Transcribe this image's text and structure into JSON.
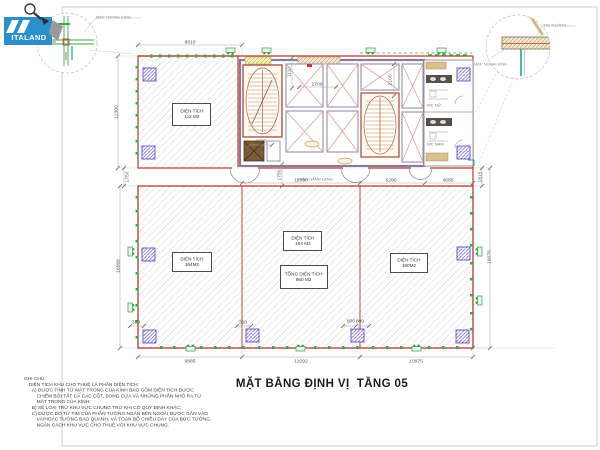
{
  "brand": {
    "name": "ITALAND"
  },
  "title": "MẶT BẰNG ĐỊNH VỊ  TẦNG 05",
  "detail_callouts": {
    "inner_glass_edge": "MÉP TRONG KÍNH",
    "wall_axis": "TIM TƯỜNG",
    "outer_glass_edge": "MÉP NGOÀI KÍNH"
  },
  "areas": {
    "room_nw": {
      "line1": "DIỆN TÍCH",
      "line2": "112 M2"
    },
    "room_sw": {
      "line1": "DIỆN TÍCH",
      "line2": "164M2"
    },
    "room_sc": {
      "line1": "DIỆN TÍCH",
      "line2": "194 M2"
    },
    "room_total": {
      "line1": "TỔNG DIỆN TÍCH",
      "line2": "660 M2"
    },
    "room_se": {
      "line1": "DIỆN TÍCH",
      "line2": "190M2"
    }
  },
  "zones": {
    "corridor": "PHẦN HÀNH LANG",
    "wc_female": "WC NỮ",
    "wc_male": "WC NAM"
  },
  "dims": {
    "top_width": "9810",
    "left_height_upper": "11380",
    "left_band": "1750",
    "left_height_lower": "16568",
    "right_band": "1815",
    "right_height_lower": "18075",
    "band_w1": "11090",
    "band_w2": "6290",
    "band_w3": "4685",
    "bottom_w1": "9885",
    "bottom_w2": "11092",
    "bottom_w3": "10975",
    "core_w1": "2700",
    "core_h1": "2100",
    "core_w2": "1500",
    "core_band": "1750",
    "core_h2": "1110",
    "col_off1": "350",
    "col_off2": "350",
    "col_off3a": "800",
    "col_off3b": "800"
  },
  "notes": {
    "heading": "GHI CHÚ:",
    "intro": "DIỆN TÍCH KHU CHO THUÊ LÀ PHẦN DIỆN TÍCH:",
    "a1": "A) ĐƯỢC TÍNH TỪ MẶT TRONG CỦA KÍNH BAO GỒM DIỆN TÍCH ĐƯỢC",
    "a2": "CHIẾM BỞI TẤT CẢ CÁC CỘT, SONG CỬA VÀ NHỮNG PHẦN NHÔ RA TỪ",
    "a3": "MẶT TRONG CỦA KÍNH;",
    "b": "B) SẼ LOẠI TRỪ KHU VỰC CHUNG TRỪ KHI CÓ QUY ĐỊNH KHÁC;",
    "c1": "C) ĐƯỢC ĐO TỪ TIM CỦA PHẦN TƯỜNG NGĂN BÊN NGOÀI ĐƯỢC GẮN VÀO",
    "c2": "VÀ/HOẶC TƯỜNG BAO QUANH, VÀ TOÀN BỘ CHIỀU DÀY CỦA BỨC TƯỜNG",
    "c3": "NGĂN CÁCH KHU VỰC CHO THUÊ VỚI KHU VỰC CHUNG."
  },
  "colors": {
    "wall_red": "#b5392c",
    "marker_green": "#2e9e3e",
    "column_purple": "#8578d8",
    "elevator_pink": "#e59c9c",
    "brand_blue": "#2b8fc9",
    "teal_accent": "#1fa5a0"
  }
}
